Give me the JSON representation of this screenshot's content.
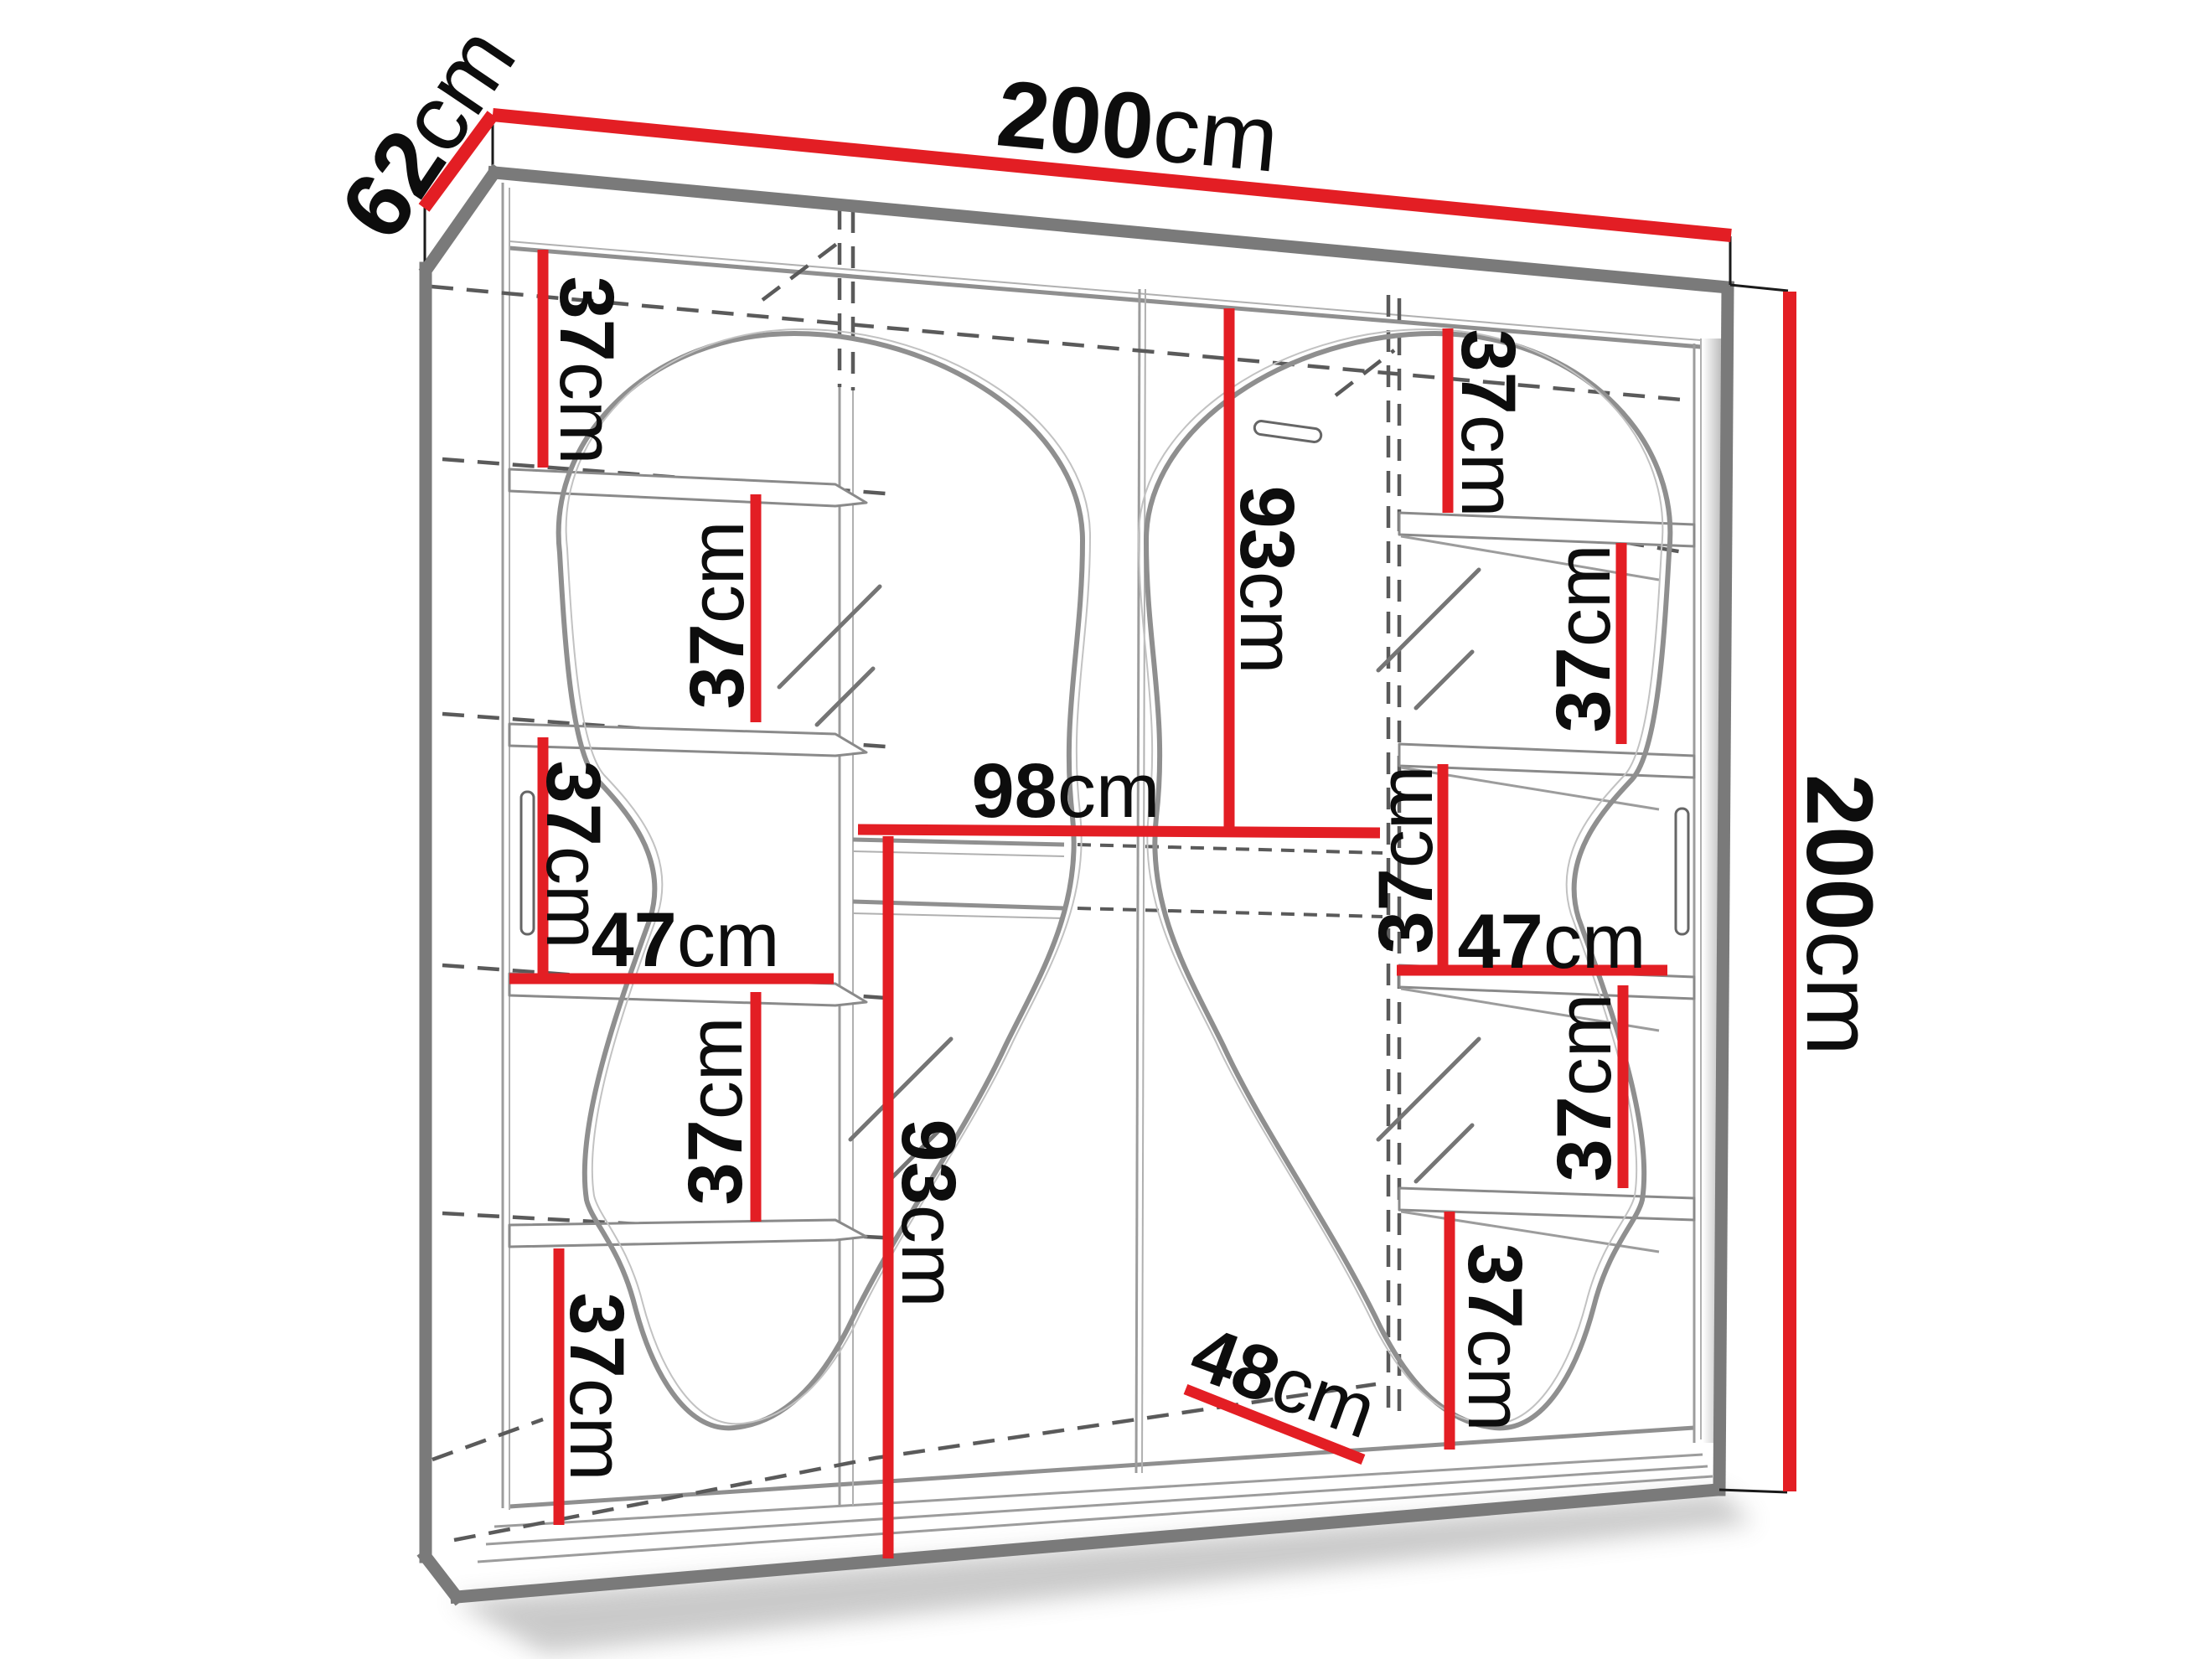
{
  "diagram": {
    "type": "furniture-dimension-diagram",
    "subject": "two-door sliding wardrobe with wavy mirror fronts, interior shelves and hanging rails"
  },
  "colors": {
    "dimension_line": "#e31e24",
    "outline_gray": "#7a7a7a",
    "thin_line": "#9c9c9c",
    "dashed_line": "#5a5a5a",
    "label_text": "#0d0d0d",
    "page_bg": "#ffffff"
  },
  "labels": {
    "width": {
      "value": "200",
      "unit": "cm"
    },
    "depth": {
      "value": "62",
      "unit": "cm"
    },
    "height": {
      "value": "200",
      "unit": "cm"
    },
    "l_gap1": {
      "value": "37",
      "unit": "cm"
    },
    "l_gap2": {
      "value": "37",
      "unit": "cm"
    },
    "l_gap3": {
      "value": "37",
      "unit": "cm"
    },
    "l_shelf_w": {
      "value": "47",
      "unit": "cm"
    },
    "l_gap4": {
      "value": "37",
      "unit": "cm"
    },
    "l_gap5": {
      "value": "37",
      "unit": "cm"
    },
    "opening_w": {
      "value": "98",
      "unit": "cm"
    },
    "l_hang_h": {
      "value": "93",
      "unit": "cm"
    },
    "r_hang_h": {
      "value": "93",
      "unit": "cm"
    },
    "r_gap1": {
      "value": "37",
      "unit": "cm"
    },
    "r_gap2": {
      "value": "37",
      "unit": "cm"
    },
    "r_gap3": {
      "value": "37",
      "unit": "cm"
    },
    "r_shelf_w": {
      "value": "47",
      "unit": "cm"
    },
    "r_gap4": {
      "value": "37",
      "unit": "cm"
    },
    "r_gap5": {
      "value": "37",
      "unit": "cm"
    },
    "bottom_depth": {
      "value": "48",
      "unit": "cm"
    }
  }
}
